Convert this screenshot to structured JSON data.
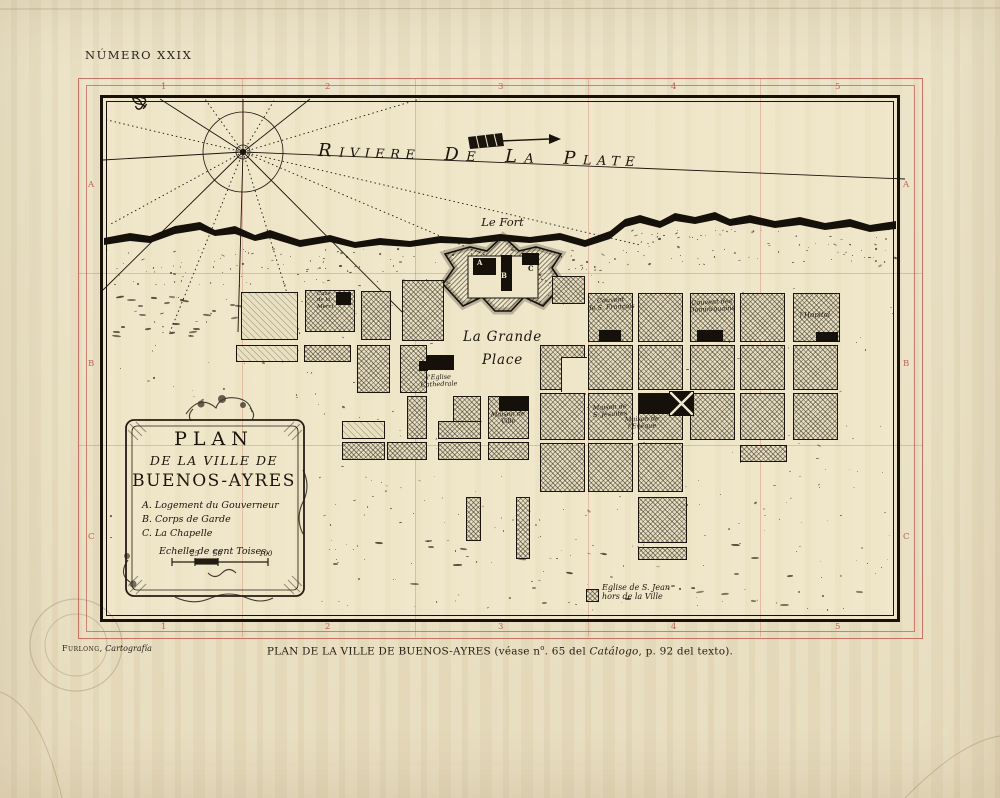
{
  "page": {
    "plate_number": "NÚMERO XXIX",
    "credit": {
      "name": "Furlong,",
      "work": "Cartografía"
    },
    "caption": {
      "p1": "PLAN DE LA VILLE DE BUENOS-AYRES (véase n",
      "sup": "o",
      "p2": ". 65 del ",
      "italic": "Catálogo",
      "p3": ", p. 92 del texto)."
    }
  },
  "plate": {
    "grid_color": "#bb5f54",
    "top_numbers": [
      "1",
      "2",
      "3",
      "4",
      "5"
    ],
    "bottom_numbers": [
      "1",
      "2",
      "3",
      "4",
      "5"
    ],
    "left_letters": [
      "A",
      "B",
      "C"
    ],
    "right_letters": [
      "A",
      "B",
      "C"
    ]
  },
  "map": {
    "ink": "#1b140c",
    "river_words": [
      "Riviere",
      "de",
      "la",
      "Plate"
    ],
    "fort_letters": [
      "A",
      "B",
      "C"
    ],
    "cartouche": {
      "line1": "PLAN",
      "line2": "DE LA VILLE DE",
      "line3": "BUENOS-AYRES",
      "legend": [
        "A. Logement du Gouverneur",
        "B. Corps de Garde",
        "C. La Chapelle"
      ],
      "scale_label": "Echelle de cent Toises.",
      "scale_ticks": [
        "25",
        "50",
        "100"
      ]
    },
    "labels": [
      {
        "id": "le-fort",
        "x": 455,
        "y": 216,
        "w": 95,
        "size": 11.5,
        "align": "center",
        "rot": 0,
        "lines": [
          "Le Fort"
        ]
      },
      {
        "id": "grande-place",
        "x": 440,
        "y": 326,
        "w": 125,
        "size": 13.5,
        "align": "center",
        "rot": 0,
        "lh": 1.7,
        "lines": [
          "La Grande",
          "Place"
        ]
      },
      {
        "id": "caze-merci",
        "x": 317,
        "y": 291,
        "w": 28,
        "size": 5.5,
        "align": "left",
        "rot": 0,
        "lines": [
          "Caze",
          "de la",
          "Merci"
        ]
      },
      {
        "id": "couvent-francois",
        "x": 585,
        "y": 297,
        "w": 52,
        "size": 6.5,
        "align": "center",
        "rot": -3,
        "lines": [
          "Couvent",
          "de S. François"
        ]
      },
      {
        "id": "couvent-dominicains",
        "x": 685,
        "y": 299,
        "w": 54,
        "size": 6.5,
        "align": "center",
        "rot": -3,
        "lines": [
          "Couvent des",
          "Dominiquains"
        ]
      },
      {
        "id": "hopital",
        "x": 789,
        "y": 311,
        "w": 52,
        "size": 7,
        "align": "center",
        "rot": -2,
        "lines": [
          "l'Hopital"
        ]
      },
      {
        "id": "eglise-cathedrale",
        "x": 412,
        "y": 374,
        "w": 54,
        "size": 6.5,
        "align": "center",
        "rot": -2,
        "lines": [
          "l'Eglise",
          "Cathedrale"
        ]
      },
      {
        "id": "maison-de-ville",
        "x": 480,
        "y": 411,
        "w": 56,
        "size": 6.5,
        "align": "center",
        "rot": -2,
        "lines": [
          "Maison de",
          "Ville"
        ]
      },
      {
        "id": "maison-jesuites",
        "x": 582,
        "y": 404,
        "w": 56,
        "size": 6.5,
        "align": "center",
        "rot": -3,
        "lines": [
          "Maison de",
          "S. Jesuites"
        ]
      },
      {
        "id": "maison-eveque",
        "x": 610,
        "y": 416,
        "w": 64,
        "size": 6.5,
        "align": "center",
        "rot": -2,
        "lines": [
          "Maison de",
          "l'Evêque"
        ]
      },
      {
        "id": "eglise-st-jean",
        "x": 602,
        "y": 583,
        "w": 110,
        "size": 8,
        "align": "left",
        "rot": 0,
        "lines": [
          "Eglise de S. Jean",
          "hors de la Ville"
        ]
      }
    ],
    "blocks": [
      [
        241,
        292,
        57,
        48,
        "l"
      ],
      [
        305,
        290,
        50,
        42,
        "x"
      ],
      [
        361,
        291,
        30,
        49,
        "x"
      ],
      [
        402,
        280,
        42,
        61,
        "x"
      ],
      [
        552,
        276,
        33,
        28,
        "x"
      ],
      [
        236,
        345,
        62,
        17,
        "l"
      ],
      [
        304,
        345,
        47,
        17,
        "x"
      ],
      [
        357,
        345,
        33,
        48,
        "x"
      ],
      [
        400,
        345,
        27,
        48,
        "x"
      ],
      [
        407,
        396,
        20,
        43,
        "x"
      ],
      [
        453,
        396,
        28,
        43,
        "x"
      ],
      [
        488,
        396,
        41,
        43,
        "x"
      ],
      [
        342,
        421,
        43,
        18,
        "l"
      ],
      [
        438,
        421,
        43,
        18,
        "x"
      ],
      [
        342,
        442,
        43,
        18,
        "x"
      ],
      [
        387,
        442,
        40,
        18,
        "x"
      ],
      [
        438,
        442,
        43,
        18,
        "x"
      ],
      [
        488,
        442,
        41,
        18,
        "x"
      ],
      [
        466,
        497,
        15,
        44,
        "x"
      ],
      [
        516,
        497,
        14,
        62,
        "x"
      ],
      [
        588,
        293,
        45,
        49,
        "x"
      ],
      [
        638,
        293,
        45,
        49,
        "x"
      ],
      [
        690,
        293,
        45,
        49,
        "x"
      ],
      [
        740,
        293,
        45,
        49,
        "x"
      ],
      [
        793,
        293,
        47,
        49,
        "x"
      ],
      [
        540,
        345,
        45,
        45,
        "x"
      ],
      [
        588,
        345,
        45,
        45,
        "x"
      ],
      [
        638,
        345,
        45,
        45,
        "x"
      ],
      [
        690,
        345,
        45,
        45,
        "x"
      ],
      [
        740,
        345,
        45,
        45,
        "x"
      ],
      [
        793,
        345,
        45,
        45,
        "x"
      ],
      [
        540,
        393,
        45,
        47,
        "x"
      ],
      [
        588,
        393,
        45,
        47,
        "x"
      ],
      [
        638,
        393,
        45,
        47,
        "x"
      ],
      [
        690,
        393,
        45,
        47,
        "x"
      ],
      [
        740,
        393,
        45,
        47,
        "x"
      ],
      [
        793,
        393,
        45,
        47,
        "x"
      ],
      [
        540,
        443,
        45,
        49,
        "x"
      ],
      [
        588,
        443,
        45,
        49,
        "x"
      ],
      [
        638,
        443,
        45,
        49,
        "x"
      ],
      [
        740,
        445,
        47,
        17,
        "x"
      ],
      [
        638,
        497,
        49,
        46,
        "x"
      ],
      [
        638,
        547,
        49,
        13,
        "x"
      ],
      [
        586,
        589,
        13,
        13,
        "x"
      ]
    ],
    "cuts": [
      [
        561,
        357,
        26,
        35
      ]
    ],
    "buildings": [
      [
        336,
        292,
        15,
        13
      ],
      [
        599,
        330,
        22,
        11
      ],
      [
        697,
        330,
        26,
        11
      ],
      [
        816,
        332,
        22,
        10
      ],
      [
        426,
        355,
        28,
        15
      ],
      [
        419,
        361,
        9,
        10
      ],
      [
        499,
        397,
        30,
        14
      ],
      [
        639,
        394,
        30,
        20
      ],
      [
        473,
        258,
        23,
        17
      ],
      [
        501,
        255,
        11,
        36
      ],
      [
        522,
        253,
        17,
        12
      ]
    ],
    "cross_building": {
      "x": 669,
      "y": 391,
      "w": 25,
      "h": 25
    }
  }
}
